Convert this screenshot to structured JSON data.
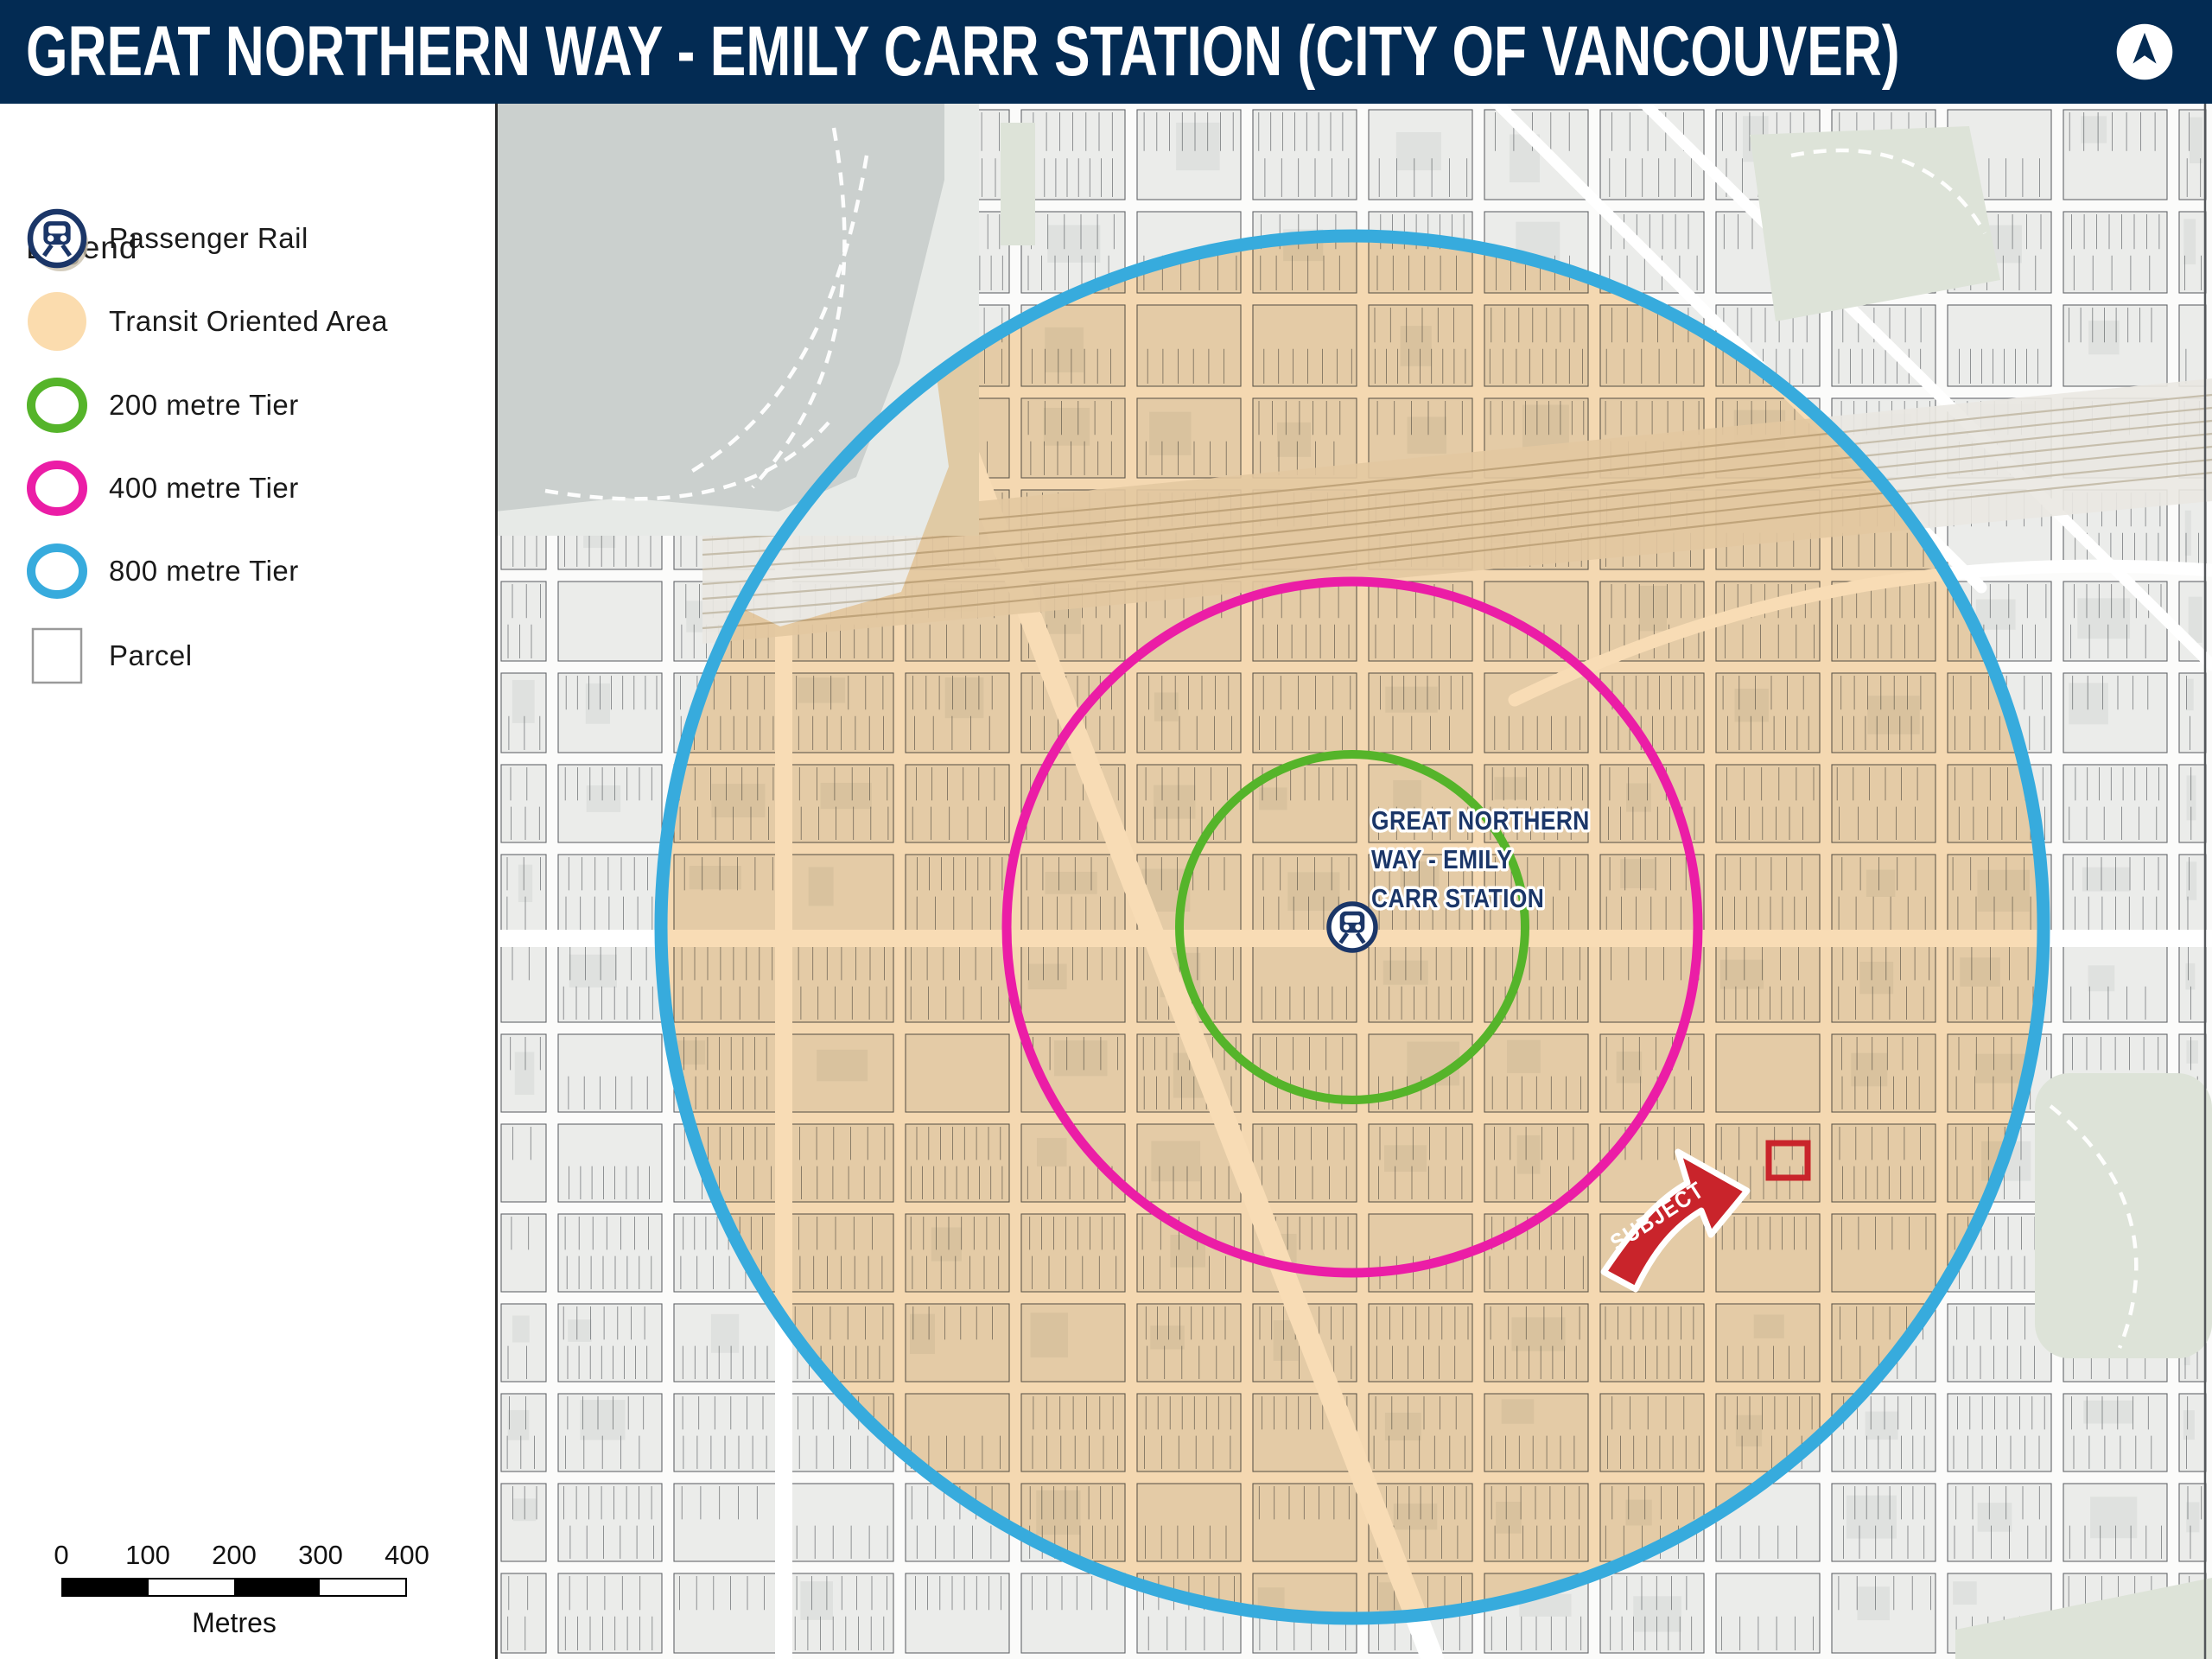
{
  "header": {
    "title": "GREAT NORTHERN WAY - EMILY CARR STATION (CITY OF VANCOUVER)"
  },
  "north_arrow": "north-arrow-compass-icon",
  "colors": {
    "header_bg": "#032b53",
    "navy": "#1b3668",
    "toa_fill": "#fbdcae",
    "toa_overlay": "#f2c078",
    "tier200": "#55b42a",
    "tier400": "#eb1da6",
    "tier800": "#37abdd",
    "subject_red": "#c9242b",
    "map_base": "#fbfbfa",
    "block": "#ebecea",
    "building": "#dfe1df",
    "lot_line": "#63666a",
    "water": "#cbd0ce",
    "park": "#dde3d8",
    "rail_line": "#c6beac",
    "street": "#ffffff",
    "parcel_border": "#9a9a9a"
  },
  "legend": {
    "heading": "Legend",
    "items": [
      {
        "id": "passenger-rail",
        "label": "Passenger Rail",
        "swatch": "rail-station-icon"
      },
      {
        "id": "transit-oriented-area",
        "label": "Transit Oriented Area",
        "swatch": "filled-circle"
      },
      {
        "id": "tier-200",
        "label": "200 metre Tier",
        "swatch": "ring"
      },
      {
        "id": "tier-400",
        "label": "400 metre Tier",
        "swatch": "ring"
      },
      {
        "id": "tier-800",
        "label": "800 metre Tier",
        "swatch": "ring"
      },
      {
        "id": "parcel",
        "label": "Parcel",
        "swatch": "square"
      }
    ]
  },
  "map": {
    "station": {
      "label_lines": [
        "GREAT NORTHERN",
        "WAY - EMILY",
        "CARR STATION"
      ],
      "icon": "passenger-rail-station-icon"
    },
    "subject": {
      "label": "SUBJECT"
    },
    "tiers": [
      {
        "label": "200 metre Tier",
        "radius_px": 200
      },
      {
        "label": "400 metre Tier",
        "radius_px": 400
      },
      {
        "label": "800 metre Tier",
        "radius_px": 800
      }
    ]
  },
  "scale_bar": {
    "ticks": [
      "0",
      "100",
      "200",
      "300",
      "400"
    ],
    "unit": "Metres"
  }
}
